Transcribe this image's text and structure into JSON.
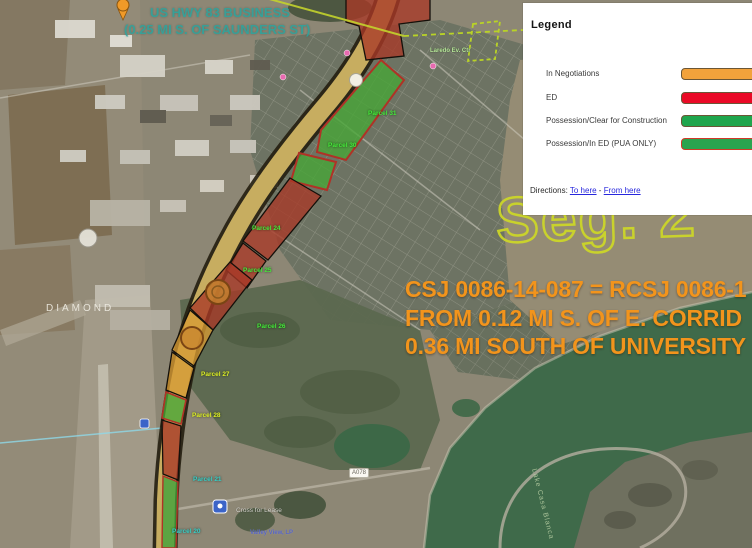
{
  "legend": {
    "title": "Legend",
    "items": [
      {
        "label": "In Negotiations",
        "color": "#f2a23b",
        "border": "#6b5636"
      },
      {
        "label": "ED",
        "color": "#ea0a26",
        "border": "#6b5636"
      },
      {
        "label": "Possession/Clear for Construction",
        "color": "#1fa64d",
        "border": "#6b5636"
      },
      {
        "label": "Possession/In ED (PUA ONLY)",
        "color": "#2aa44f",
        "border": "#d03a28"
      }
    ],
    "directions": {
      "label": "Directions:",
      "to_link": "To here",
      "separator": "-",
      "from_link": "From here"
    }
  },
  "overlay": {
    "csj_lines": [
      "CSJ 0086-14-087 = RCSJ 0086-1",
      "FROM 0.12 MI S. OF E. CORRID",
      "0.36 MI SOUTH OF UNIVERSITY"
    ],
    "csj_color": "#f2941c",
    "segment_watermark": "Seg. 2",
    "teal_lines": [
      "US HWY 83 BUSINESS",
      "(0.25 MI S. OF SAUNDERS ST)"
    ]
  },
  "map": {
    "status_colors": {
      "in_negotiations": "#d79b33",
      "ed": "#a83826",
      "possession_clear": "#47a636"
    },
    "labels": [
      {
        "text": "Parcel 31",
        "x": 368,
        "y": 110,
        "cls": "lbl-green"
      },
      {
        "text": "Parcel 30",
        "x": 328,
        "y": 142,
        "cls": "lbl-green"
      },
      {
        "text": "Parcel 24",
        "x": 252,
        "y": 225,
        "cls": "lbl-green"
      },
      {
        "text": "Parcel 25",
        "x": 243,
        "y": 267,
        "cls": "lbl-green"
      },
      {
        "text": "Parcel 26",
        "x": 257,
        "y": 323,
        "cls": "lbl-green"
      },
      {
        "text": "Parcel 27",
        "x": 201,
        "y": 371,
        "cls": "lbl-yellow"
      },
      {
        "text": "Parcel 28",
        "x": 192,
        "y": 412,
        "cls": "lbl-yellow"
      },
      {
        "text": "Parcel 21",
        "x": 193,
        "y": 476,
        "cls": "lbl-tealsm"
      },
      {
        "text": "Parcel 20",
        "x": 172,
        "y": 528,
        "cls": "lbl-tealsm"
      },
      {
        "text": "DIAMOND",
        "x": 46,
        "y": 303,
        "cls": "lbl-place"
      },
      {
        "text": "Laredo Ev. Ctr",
        "x": 430,
        "y": 48,
        "cls": "lbl-poi"
      },
      {
        "text": "Cross for Lease",
        "x": 236,
        "y": 507,
        "cls": "lbl-white"
      },
      {
        "text": "Valley View, LP",
        "x": 250,
        "y": 530,
        "cls": "lbl-navy"
      },
      {
        "text": "A078",
        "x": 349,
        "y": 468,
        "cls": "lbl-roadbox"
      },
      {
        "text": "Lake Casa Blanca",
        "x": 537,
        "y": 468,
        "cls": "lbl-lake",
        "rot": 76
      }
    ]
  }
}
